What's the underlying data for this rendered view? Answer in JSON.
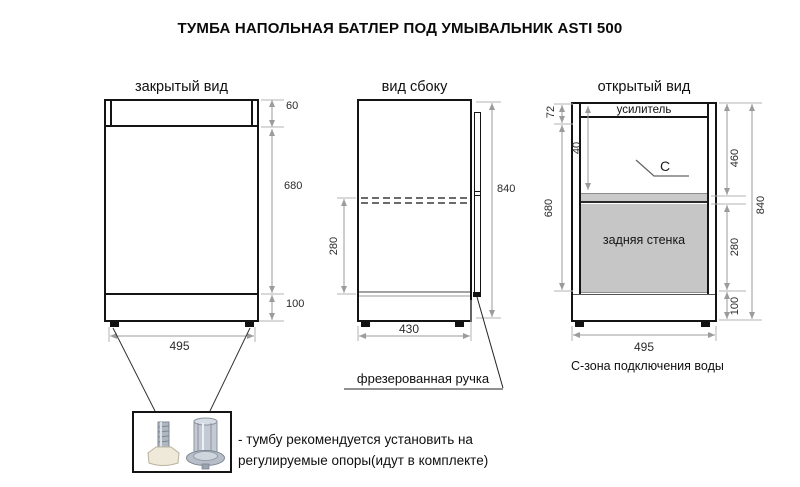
{
  "page_title": "ТУМБА НАПОЛЬНАЯ БАТЛЕР ПОД УМЫВАЛЬНИК ASTI 500",
  "views": {
    "closed": {
      "title": "закрытый вид",
      "dim_top": "60",
      "dim_body": "680",
      "dim_plinth": "100",
      "dim_width": "495"
    },
    "side": {
      "title": "вид сбоку",
      "dim_height": "840",
      "dim_drawer": "280",
      "dim_width": "430",
      "handle_label": "фрезерованная ручка"
    },
    "open": {
      "title": "открытый вид",
      "reinforcement_label": "усилитель",
      "back_panel_label": "задняя стенка",
      "zone_marker": "C",
      "dim_top": "72",
      "dim_inner": "40",
      "dim_body": "680",
      "dim_upper": "460",
      "dim_back": "280",
      "dim_plinth": "100",
      "dim_height": "840",
      "dim_width": "495",
      "caption": "С-зона подключения воды"
    }
  },
  "note": {
    "line1": "- тумбу рекомендуется установить на",
    "line2": "регулируемые опоры(идут в комплекте)"
  },
  "colors": {
    "line": "#141414",
    "dimension": "#9b9b9b",
    "shelf_fill": "#cacaca",
    "back_panel_fill": "#c6c6c6"
  }
}
